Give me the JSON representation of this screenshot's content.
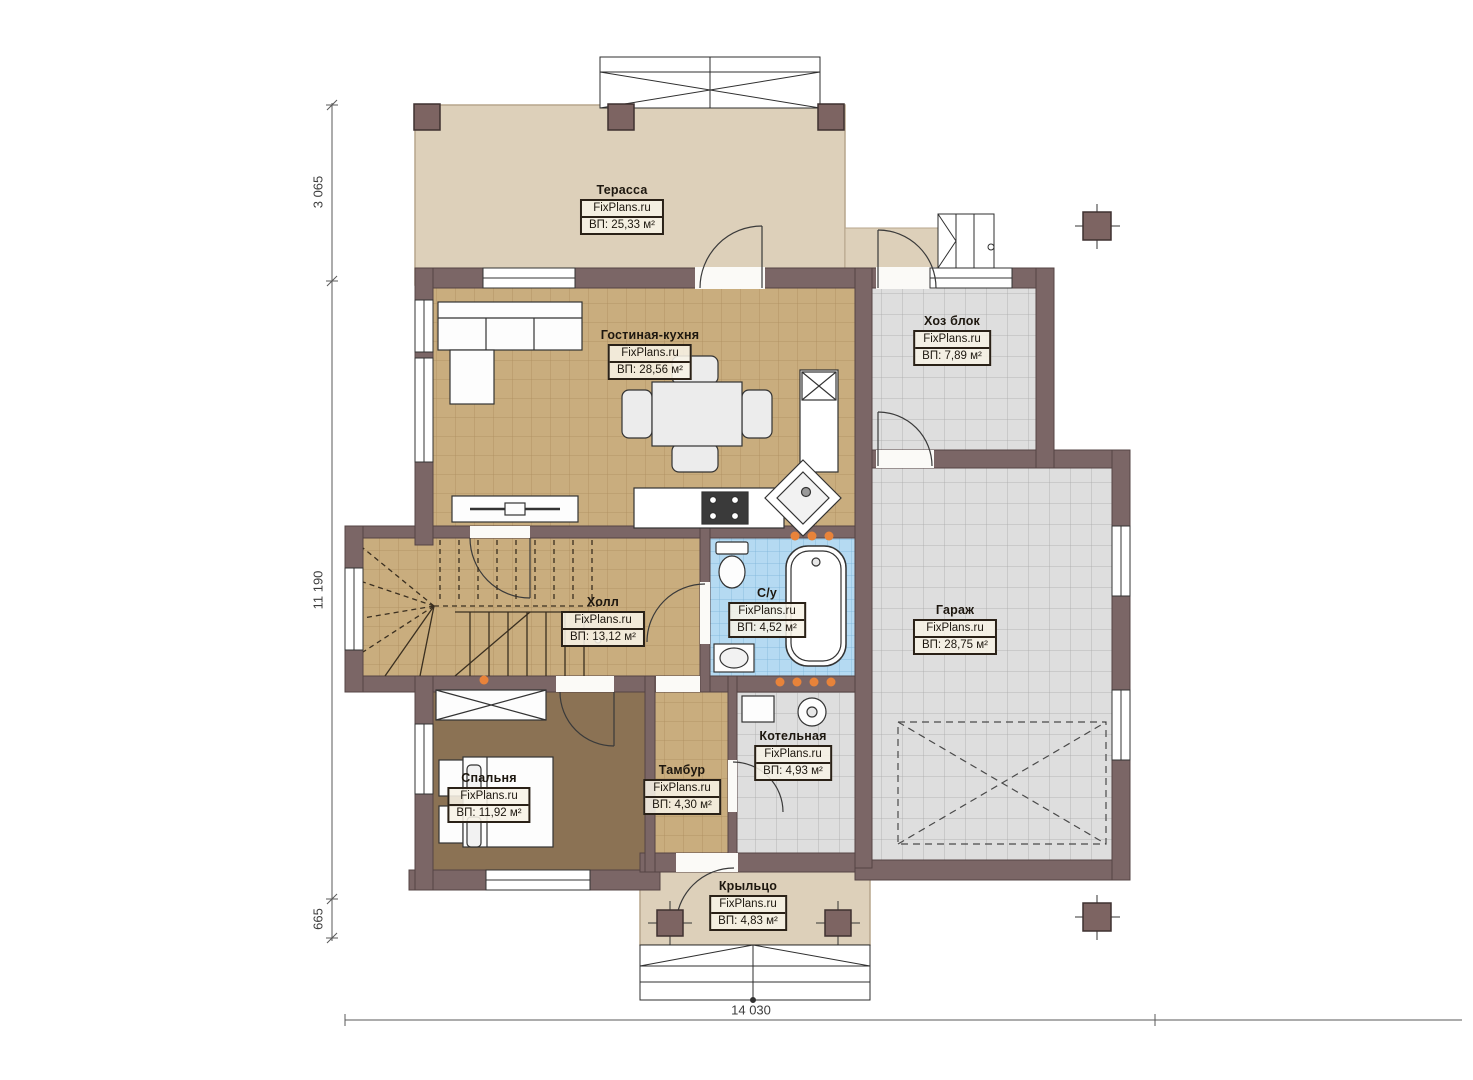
{
  "plan": {
    "brand": "FixPlans.ru",
    "rooms": [
      {
        "name": "Терасса",
        "watermark": "FixPlans.ru",
        "area": "ВП: 25,33 м²"
      },
      {
        "name": "Гостиная-кухня",
        "watermark": "FixPlans.ru",
        "area": "ВП: 28,56 м²"
      },
      {
        "name": "Хоз блок",
        "watermark": "FixPlans.ru",
        "area": "ВП: 7,89 м²"
      },
      {
        "name": "Холл",
        "watermark": "FixPlans.ru",
        "area": "ВП: 13,12 м²"
      },
      {
        "name": "С/у",
        "watermark": "FixPlans.ru",
        "area": "ВП: 4,52 м²"
      },
      {
        "name": "Гараж",
        "watermark": "FixPlans.ru",
        "area": "ВП: 28,75 м²"
      },
      {
        "name": "Спальня",
        "watermark": "FixPlans.ru",
        "area": "ВП: 11,92 м²"
      },
      {
        "name": "Тамбур",
        "watermark": "FixPlans.ru",
        "area": "ВП: 4,30 м²"
      },
      {
        "name": "Котельная",
        "watermark": "FixPlans.ru",
        "area": "ВП: 4,93 м²"
      },
      {
        "name": "Крыльцо",
        "watermark": "FixPlans.ru",
        "area": "ВП: 4,83 м²"
      }
    ],
    "dimensions": {
      "left_top": "3 065",
      "left_middle": "11 190",
      "left_bottom": "665",
      "bottom": "14 030"
    },
    "colors": {
      "wall": "#7b6666",
      "terrace": "#ddd0ba",
      "tan_floor": "#c9ad7e",
      "gray_tile": "#dedede",
      "blue_tile": "#b5daf2",
      "carpet": "#8b7254",
      "marker_orange": "#e8833a"
    }
  }
}
